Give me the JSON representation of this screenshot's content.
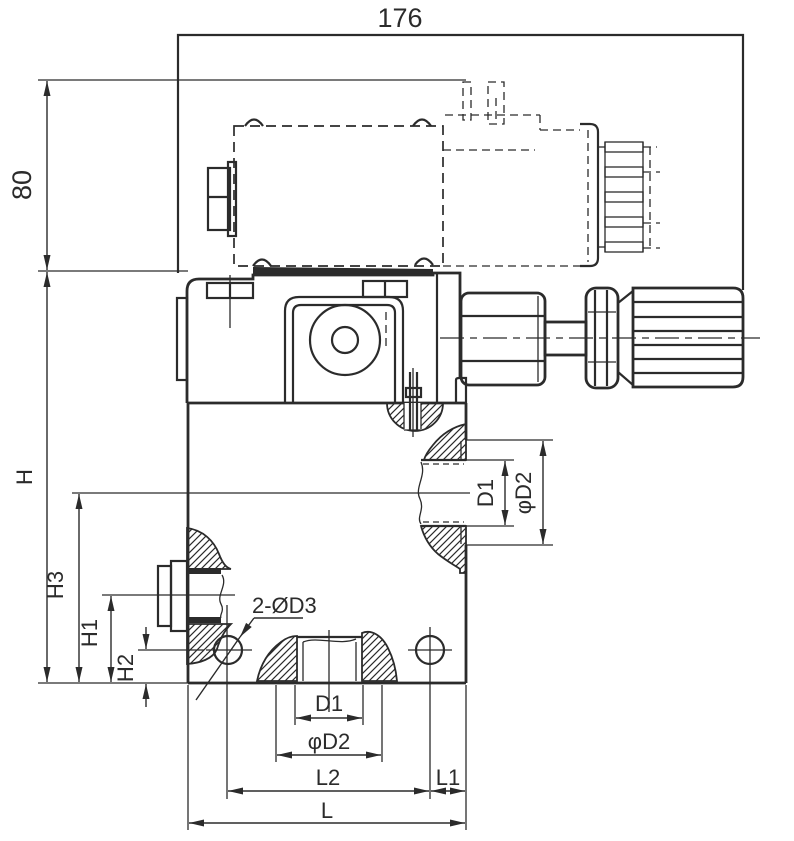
{
  "drawing": {
    "colors": {
      "line": "#2b2b2b",
      "background": "#ffffff"
    },
    "labels": {
      "width_overall": "176",
      "height_top": "80",
      "height_overall": "H",
      "height_h3": "H3",
      "height_h1": "H1",
      "height_h2": "H2",
      "bolt_holes": "2-ØD3",
      "side_port_d1": "D1",
      "side_port_d2": "φD2",
      "bottom_port_d1": "D1",
      "bottom_port_d2": "φD2",
      "length_l2": "L2",
      "length_l1": "L1",
      "length_overall": "L"
    }
  }
}
